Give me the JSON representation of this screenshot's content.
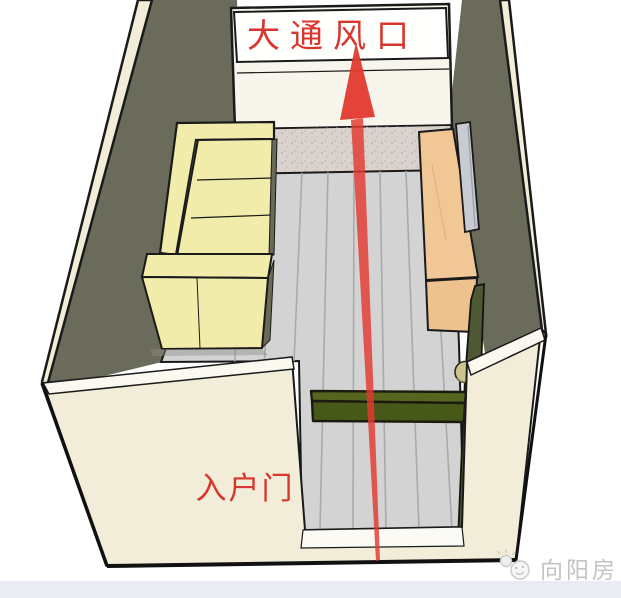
{
  "scene": {
    "labels": {
      "vent": "大通风口",
      "entry_door": "入户门"
    },
    "watermark": {
      "text": "向阳房"
    },
    "colors": {
      "wall_face": "#F2EDD8",
      "wall_top": "#FAF8EF",
      "wall_shadow": "#6B6B5B",
      "back_wall": "#F8F6EC",
      "vent_white": "#FFFFFE",
      "granite": "#D9D2CD",
      "floor": "#D3D3D3",
      "plank_line": "#A9A9A9",
      "sofa": "#F2ECAB",
      "sofa_shadow": "#6A6A59",
      "wood_top": "#F1C795",
      "wood_front": "#EEC28D",
      "panel": "#C8CCD2",
      "green_top": "#57661F",
      "green_front": "#475819",
      "door_leaf": "#4E5833",
      "knob": "#CCC68D",
      "threshold": "#FBFAF4",
      "arrow": "#E3392F",
      "label_red": "#D8362C",
      "watermark_gray": "#C3C3C3",
      "footer_bar": "#E9EDF3"
    }
  }
}
